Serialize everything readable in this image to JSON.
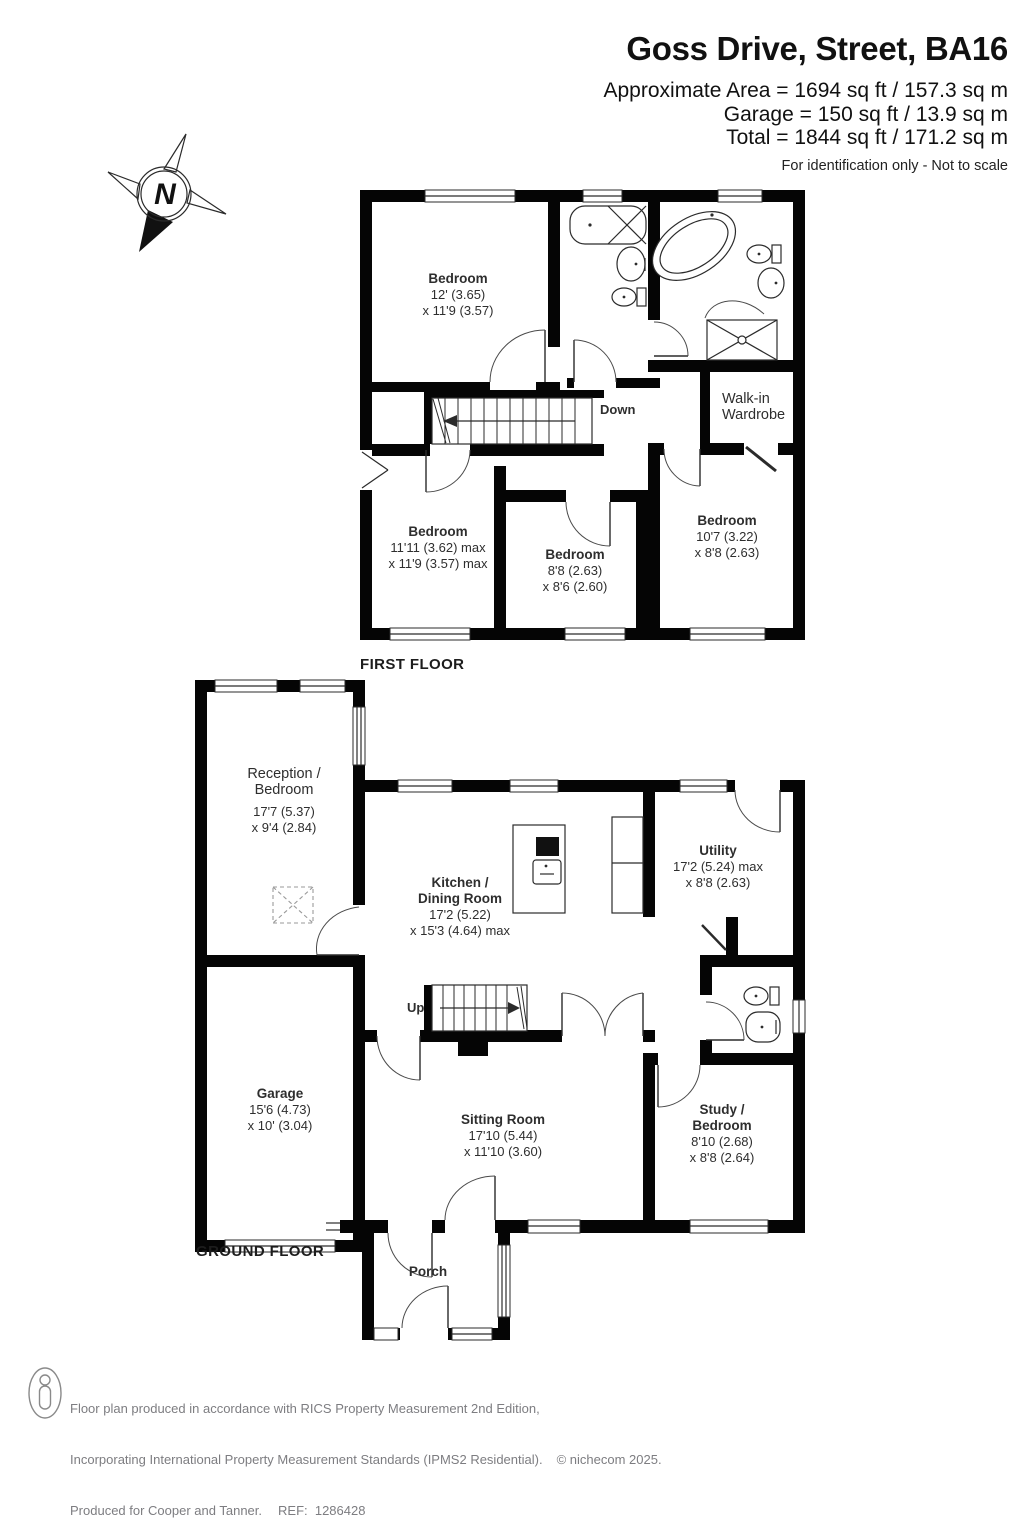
{
  "header": {
    "title": "Goss Drive, Street, BA16",
    "lines": [
      "Approximate Area = 1694 sq ft / 157.3 sq m",
      "Garage = 150 sq ft / 13.9 sq m",
      "Total = 1844 sq ft / 171.2 sq m"
    ],
    "disclaimer": "For identification only - Not to scale"
  },
  "compass": {
    "north_label": "N"
  },
  "first_floor": {
    "floor_label": "FIRST FLOOR",
    "stairs_label": "Down",
    "rooms": {
      "bedroom_front": {
        "name": "Bedroom",
        "dim1": "12' (3.65)",
        "dim2": "x 11'9 (3.57)"
      },
      "bedroom_left": {
        "name": "Bedroom",
        "dim1": "11'11 (3.62) max",
        "dim2": "x 11'9 (3.57) max"
      },
      "bedroom_middle": {
        "name": "Bedroom",
        "dim1": "8'8 (2.63)",
        "dim2": "x 8'6 (2.60)"
      },
      "bedroom_right": {
        "name": "Bedroom",
        "dim1": "10'7 (3.22)",
        "dim2": "x 8'8 (2.63)"
      },
      "wardrobe": {
        "name": "Walk-in\nWardrobe"
      }
    }
  },
  "ground_floor": {
    "floor_label": "GROUND FLOOR",
    "stairs_label": "Up",
    "rooms": {
      "reception": {
        "name": "Reception /\nBedroom",
        "dim1": "17'7 (5.37)",
        "dim2": "x 9'4 (2.84)"
      },
      "garage": {
        "name": "Garage",
        "dim1": "15'6 (4.73)",
        "dim2": "x 10' (3.04)"
      },
      "kitchen": {
        "name": "Kitchen /\nDining Room",
        "dim1": "17'2 (5.22)",
        "dim2": "x 15'3 (4.64) max"
      },
      "utility": {
        "name": "Utility",
        "dim1": "17'2 (5.24) max",
        "dim2": "x 8'8 (2.63)"
      },
      "sitting": {
        "name": "Sitting Room",
        "dim1": "17'10 (5.44)",
        "dim2": "x 11'10 (3.60)"
      },
      "study": {
        "name": "Study /\nBedroom",
        "dim1": "8'10 (2.68)",
        "dim2": "x 8'8 (2.64)"
      },
      "porch": {
        "name": "Porch"
      }
    }
  },
  "footer": {
    "line1": "Floor plan produced in accordance with RICS Property Measurement 2nd Edition,",
    "line2": "Incorporating International Property Measurement Standards (IPMS2 Residential).",
    "copyright": "© nichecom 2025.",
    "line3": "Produced for Cooper and Tanner.",
    "ref": "REF:  1286428"
  },
  "colors": {
    "wall": "#050505",
    "text": "#2e2e2e",
    "footer_text": "#7d7d81"
  }
}
